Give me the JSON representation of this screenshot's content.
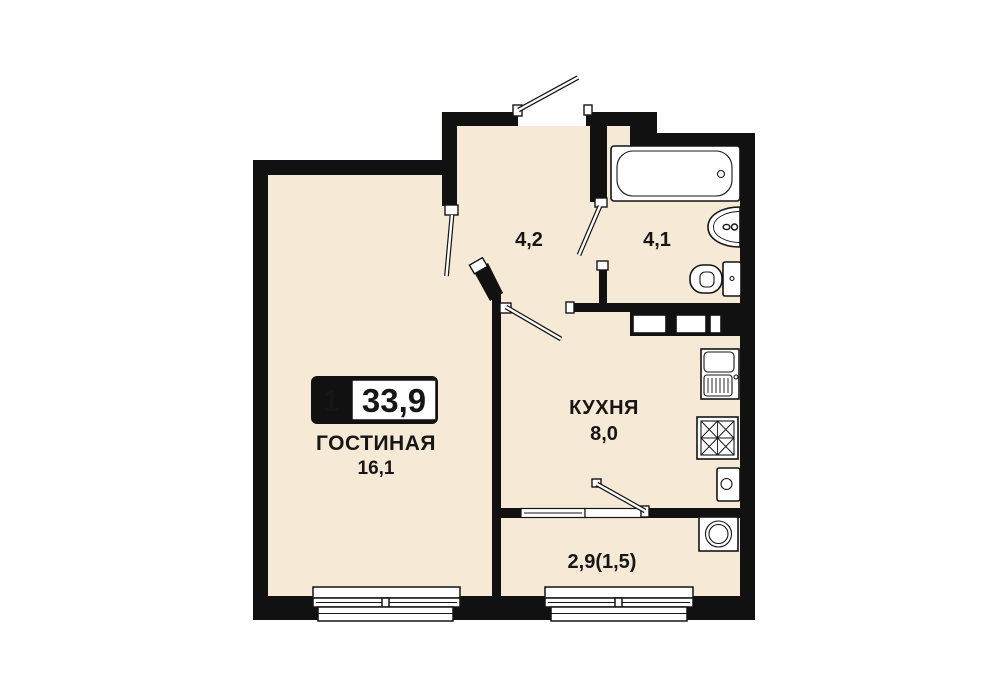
{
  "badge": {
    "room_count": "1",
    "total_area": "33,9"
  },
  "rooms": {
    "living": {
      "name": "ГОСТИНАЯ",
      "area": "16,1"
    },
    "kitchen": {
      "name": "КУХНЯ",
      "area": "8,0"
    },
    "hallway": {
      "area": "4,2"
    },
    "bathroom": {
      "area": "4,1"
    },
    "balcony": {
      "area": "2,9(1,5)"
    }
  },
  "colors": {
    "wall": "#111111",
    "floor": "#f6e9d6",
    "background": "#ffffff",
    "fixture_fill": "#ffffff",
    "text": "#161616"
  },
  "fixtures": [
    "bathtub",
    "washbasin",
    "toilet",
    "kitchen-sink",
    "stove",
    "water-heater",
    "washing-machine",
    "vent-shaft"
  ]
}
